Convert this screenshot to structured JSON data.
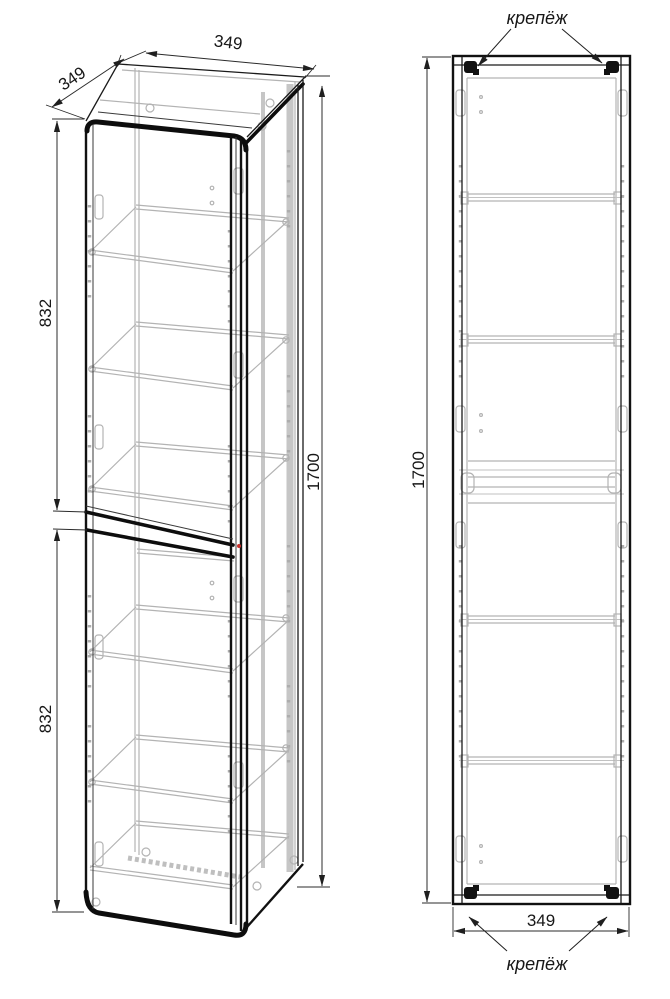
{
  "perspective_view": {
    "dim_depth_top": "349",
    "dim_width_top": "349",
    "dim_upper_section_height": "832",
    "dim_lower_section_height": "832",
    "dim_total_height": "1700"
  },
  "front_view": {
    "dim_total_height": "1700",
    "dim_bottom_width": "349",
    "fastener_label_top": "крепёж",
    "fastener_label_bottom": "крепёж"
  },
  "colors": {
    "outline": "#1a1a1a",
    "secondary_line": "#b3b3b3",
    "dimension_line": "#2b2b2b",
    "background": "#ffffff",
    "accent_dot": "#c9302c"
  }
}
